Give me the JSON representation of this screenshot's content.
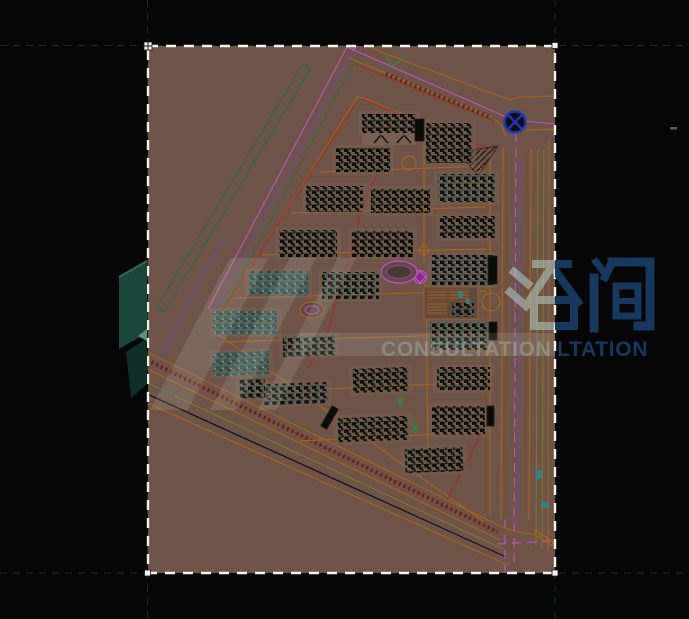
{
  "image": {
    "width": 689,
    "height": 619,
    "kind": "cad-site-plan-preview",
    "description": "Residential community master plan CAD drawing on dark canvas with dashed sheet frame and consultation-company watermark"
  },
  "colors": {
    "black": "#060606",
    "sheetBg": "#6d5348",
    "inkDash": "#16351f",
    "white": "#f2f2ec",
    "orange": "#a4641c",
    "orangeDk": "#7e4c12",
    "olive": "#7c7c26",
    "red": "#9e2f26",
    "redDk": "#5f1f16",
    "magenta": "#c352c3",
    "green": "#2e6b3c",
    "blue": "#2336b4",
    "violet": "#6a48c0",
    "navy": "#16375e",
    "wmLight": "#bcd9d2",
    "clusterPad": "#7a6251",
    "tealBit": "#2e8585"
  },
  "sheet": {
    "x": 148,
    "y": 46,
    "width": 407,
    "height": 527
  },
  "watermark": {
    "cn_text": "咨询",
    "en_text": "CONSULTATION",
    "en_dark_segment": "LTATION",
    "logo": "consultation-logo"
  },
  "plan": {
    "roundabout": {
      "cx": 515,
      "cy": 122,
      "r": 10.5
    },
    "pond": {
      "cx": 399,
      "cy": 272,
      "rx": 18,
      "ry": 11
    },
    "garden_oval": {
      "cx": 312,
      "cy": 310,
      "rx": 12,
      "ry": 8
    },
    "clusters": [
      {
        "x": 362,
        "y": 114,
        "w": 54,
        "h": 19,
        "k": "dark",
        "r": 0
      },
      {
        "x": 426,
        "y": 123,
        "w": 46,
        "h": 40,
        "k": "dark",
        "r": 0
      },
      {
        "x": 336,
        "y": 148,
        "w": 54,
        "h": 24,
        "k": "dark",
        "r": 0
      },
      {
        "x": 438,
        "y": 174,
        "w": 57,
        "h": 28,
        "k": "mix",
        "r": 0
      },
      {
        "x": 306,
        "y": 186,
        "w": 57,
        "h": 26,
        "k": "dark",
        "r": 0
      },
      {
        "x": 371,
        "y": 189,
        "w": 59,
        "h": 24,
        "k": "dark",
        "r": 0
      },
      {
        "x": 440,
        "y": 216,
        "w": 55,
        "h": 22,
        "k": "dark",
        "r": 0
      },
      {
        "x": 279,
        "y": 230,
        "w": 58,
        "h": 27,
        "k": "dark",
        "r": 0
      },
      {
        "x": 352,
        "y": 231,
        "w": 61,
        "h": 26,
        "k": "dark",
        "r": 0
      },
      {
        "x": 431,
        "y": 255,
        "w": 62,
        "h": 30,
        "k": "mix",
        "r": 0
      },
      {
        "x": 249,
        "y": 271,
        "w": 59,
        "h": 25,
        "k": "teal",
        "r": 0
      },
      {
        "x": 322,
        "y": 272,
        "w": 57,
        "h": 27,
        "k": "mix",
        "r": 0
      },
      {
        "x": 213,
        "y": 311,
        "w": 64,
        "h": 23,
        "k": "teal",
        "r": 0
      },
      {
        "x": 283,
        "y": 336,
        "w": 52,
        "h": 20,
        "k": "mix",
        "r": -2
      },
      {
        "x": 430,
        "y": 322,
        "w": 58,
        "h": 28,
        "k": "mix",
        "r": 0
      },
      {
        "x": 213,
        "y": 352,
        "w": 56,
        "h": 23,
        "k": "teal",
        "r": -2
      },
      {
        "x": 353,
        "y": 368,
        "w": 55,
        "h": 24,
        "k": "dark",
        "r": -2
      },
      {
        "x": 437,
        "y": 367,
        "w": 53,
        "h": 23,
        "k": "dark",
        "r": 0
      },
      {
        "x": 263,
        "y": 383,
        "w": 65,
        "h": 21,
        "k": "mix",
        "r": -2
      },
      {
        "x": 239,
        "y": 379,
        "w": 26,
        "h": 19,
        "k": "mix",
        "r": -2
      },
      {
        "x": 432,
        "y": 406,
        "w": 53,
        "h": 29,
        "k": "dark",
        "r": 0
      },
      {
        "x": 338,
        "y": 417,
        "w": 70,
        "h": 24,
        "k": "dark",
        "r": -2
      },
      {
        "x": 405,
        "y": 448,
        "w": 58,
        "h": 24,
        "k": "dark",
        "r": -2
      }
    ],
    "bars": [
      {
        "x": 488,
        "y": 256,
        "w": 9,
        "h": 28,
        "r": 0
      },
      {
        "x": 489,
        "y": 322,
        "w": 8,
        "h": 18,
        "r": 0
      },
      {
        "x": 487,
        "y": 406,
        "w": 7,
        "h": 20,
        "r": 0
      },
      {
        "x": 415,
        "y": 119,
        "w": 9,
        "h": 22,
        "r": 0
      },
      {
        "x": 326,
        "y": 406,
        "w": 7,
        "h": 23,
        "r": 30
      }
    ]
  }
}
